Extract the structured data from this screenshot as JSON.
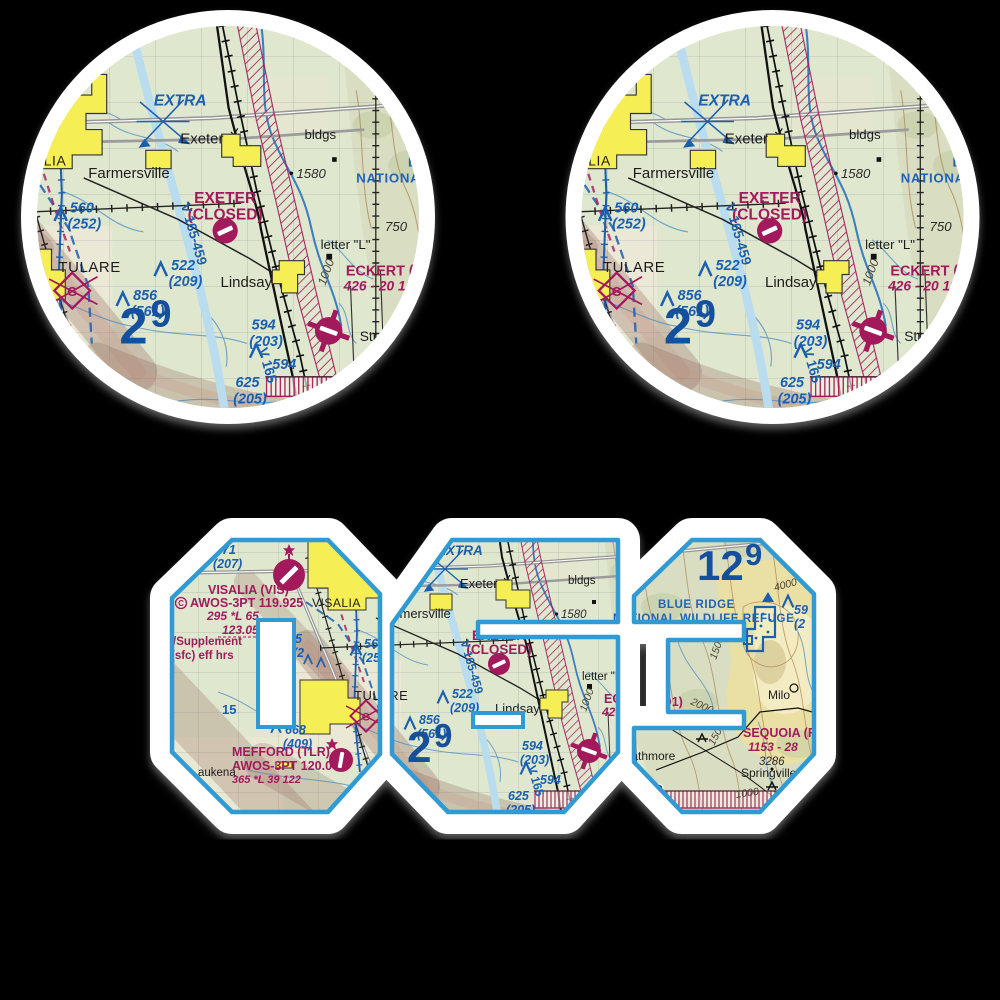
{
  "scene": {
    "type": "sticker-sheet-product-image",
    "background": "#000000",
    "description": "Two round VFR sectional chart stickers (Exeter / Lindsay CA area) and one sticker die-cut in the shape of the airport code 063 filled with the same sectional chart"
  },
  "stickers": {
    "circle_sticker_count": 2,
    "shape_sticker_text": "063",
    "shape_digits": [
      "0",
      "6",
      "3"
    ]
  },
  "colors": {
    "background": "#000000",
    "sticker_white": "#ffffff",
    "digit_outline_blue": "#2f9ad3",
    "chart_magenta": "#a21a5c",
    "chart_blue": "#1a5fb0",
    "mef_blue": "#15509d",
    "valley_green": "#dfe7cf",
    "hills_green": "#d9ddc1",
    "terrain_tan": "#ecdfa2",
    "city_yellow": "#f6ee55",
    "water_blue": "#b9ddef",
    "shade_brown": "#8d5a4e"
  },
  "map": {
    "labels": {
      "extra": "EXTRA",
      "exeter_town": "Exeter",
      "farmersville": "Farmersville",
      "tulare": "TULARE",
      "lindsay": "Lindsay",
      "strathmore": "Strathmore",
      "springville": "Springville",
      "milo": "Milo",
      "waukena_partial": "aukena",
      "visalia_town": "VISALIA",
      "bldgs": "bldgs",
      "letter_l": "letter \"L\"",
      "spot_1580": "1580",
      "spot_750": "750",
      "spot_3286": "3286",
      "contour_1000": "1000",
      "contour_1500": "1500",
      "contour_2000": "2000",
      "contour_4000": "4000",
      "exeter_airport_line1": "EXETER",
      "exeter_airport_line2": "(CLOSED)",
      "eckert_line1": "ECKERT (",
      "eckert_line2": "426 - 20 12",
      "visalia_airport_line1": "VISALIA (VIS)",
      "visalia_awos": "AWOS-3PT 119.925",
      "visalia_info": "295 *L 65",
      "visalia_freq": "123.05",
      "visalia_supp1": "/Supplement",
      "visalia_supp2": "(sfc) eff hrs",
      "mefford_line1": "MEFFORD (TLR)",
      "mefford_awos": "AWOS-3PT 120.0",
      "mefford_info": "365 *L 39 122",
      "sequoia_line1": "SEQUOIA (R",
      "sequoia_line2": "1153 - 28",
      "q1_partial": "Q1)",
      "refuge_line1": "BLUE RIDGE",
      "refuge_line2": "NATIONAL WILDLIFE REFUGE",
      "airway_1": "V 165-459",
      "airway_2": "V 165",
      "route_15": "15",
      "longitude": "119°",
      "obst_471": "471",
      "obst_471_agl": "(207)",
      "obst_560": "560",
      "obst_560_agl": "(252)",
      "obst_522": "522",
      "obst_522_agl": "(209)",
      "obst_856": "856",
      "obst_856_agl": "(561)",
      "obst_594": "594",
      "obst_594_agl": "(203)",
      "obst_594b": "594",
      "obst_625": "625",
      "obst_625_agl": "(205)",
      "obst_668": "668",
      "obst_668_agl": "(409)",
      "obst_59": "59",
      "obst_59_agl": "(2",
      "obst_frag": "5",
      "obst_frag_agl": "(2",
      "mef_valley_thousands": "2",
      "mef_valley_hundreds": "9",
      "mef_ridge_thousands": "12",
      "mef_ridge_hundreds": "9",
      "circled_c": "C",
      "glider_g": "G"
    }
  }
}
